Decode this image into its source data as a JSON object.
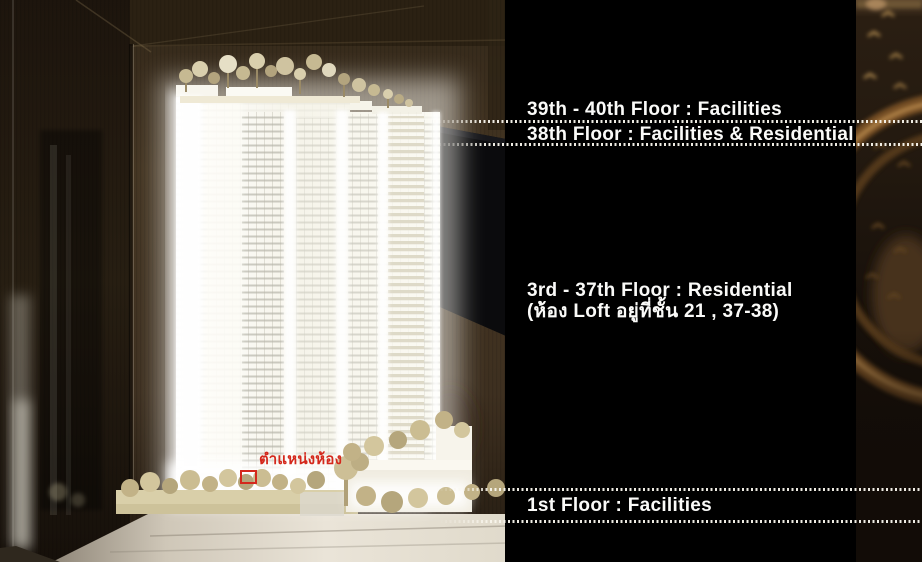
{
  "annotations": {
    "floors": [
      {
        "label": "39th - 40th Floor : Facilities"
      },
      {
        "label": "38th Floor : Facilities & Residential"
      },
      {
        "label": "3rd - 37th Floor : Residential",
        "sublabel": "(ห้อง Loft อยู่ที่ชั้น 21 , 37-38)"
      },
      {
        "label": "1st Floor : Facilities"
      }
    ],
    "room_position": {
      "label": "ตำแหน่งห้อง",
      "marker_color": "#d4281c"
    }
  },
  "colors": {
    "label_text": "#fafaf8",
    "leader_dots": "#f8f5ec",
    "overlay_panel": "#000000",
    "wall_brown": "#443522",
    "accent_red": "#d4281c",
    "model_glow": "#ffffff",
    "tree_beige": "#c6b992",
    "amber_highlight": "#c49455"
  }
}
